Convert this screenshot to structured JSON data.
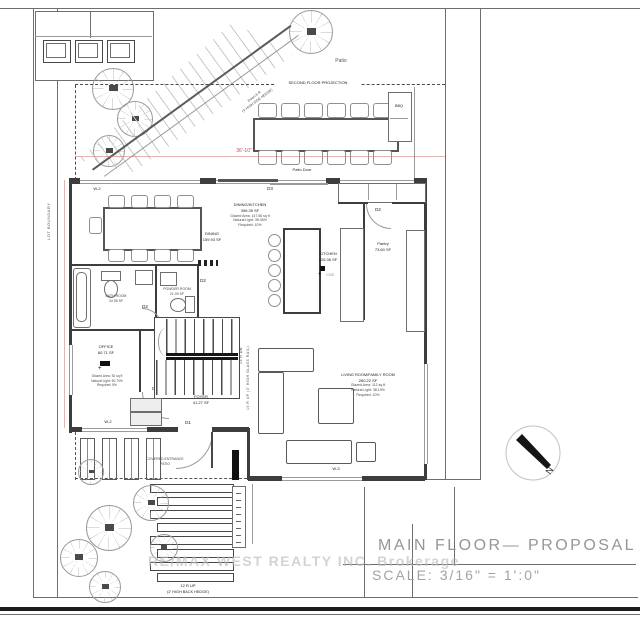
{
  "site": {
    "lot_boundary": "LOT BOUNDARY"
  },
  "patio": {
    "label": "Patio",
    "second_floor": "SECOND FLOOR PROJECTION",
    "bbq": "BBQ",
    "stair_note_1": "Down 6 R",
    "stair_note_2": "(3' HIGH SIDE HEDGE)"
  },
  "doors": {
    "d1": "D1",
    "d2": "D2",
    "d3": "D3",
    "patio_door": "Patio Door"
  },
  "windows": {
    "w2": "W-2",
    "w3": "W-3"
  },
  "rooms": {
    "dining_kitchen": {
      "name": "DINING/KITCHEN",
      "area": "396.39 SF",
      "glazed": "Glazed Area: 147.56 sq ft",
      "light": "Natural Light: 35.06%",
      "required": "Required: 10%"
    },
    "dining": {
      "name": "DINING",
      "area": "159.93 SF"
    },
    "kitchen": {
      "name": "KITCHEN",
      "area": "226.36 SF",
      "detector": "CMD"
    },
    "pantry": {
      "name": "Pantry",
      "area": "73.60 SF"
    },
    "bath": {
      "name": "BATH ROOM",
      "area": "34.95 SF"
    },
    "powder": {
      "name": "POWDER ROOM",
      "area": "21.09 SF"
    },
    "office": {
      "name": "OFFICE",
      "area": "60.71 SF",
      "glazed": "Glazed Area: 30 sq ft",
      "light": "Natural Light: 50.70%",
      "required": "Required: 5%"
    },
    "foyer": {
      "name": "FOYER",
      "area": "41.27 SF"
    },
    "living": {
      "name": "LIVING ROOM/FAMILY ROOM",
      "area": "260.22 SF",
      "glazed": "Glazed Area: 112 sq ft",
      "light": "Natural Light: 38.19%",
      "required": "Required: 10%"
    },
    "covered_patio": {
      "name": "COVERED ENTRANCE",
      "name2": "PATIO"
    }
  },
  "stairs": {
    "down": "15 R DN",
    "up": "15 R UP (3' HIGH GLASS RAIL)"
  },
  "exterior_steps": {
    "label": "12 R UP",
    "hedge": "(2' HIGH BACK HEDGE)"
  },
  "dimensions": {
    "top": "36'-10\""
  },
  "compass": {
    "north": "N"
  },
  "watermark": "RE/MAX WEST REALTY INC. Brokerage",
  "title_block": {
    "title": "MAIN FLOOR— PROPOSAL",
    "scale": "SCALE: 3/16\" = 1':0\""
  },
  "colors": {
    "wall": "#3d3d3d",
    "dimension_red": "#c0504d",
    "watermark_gray": "#bcbcbc"
  }
}
